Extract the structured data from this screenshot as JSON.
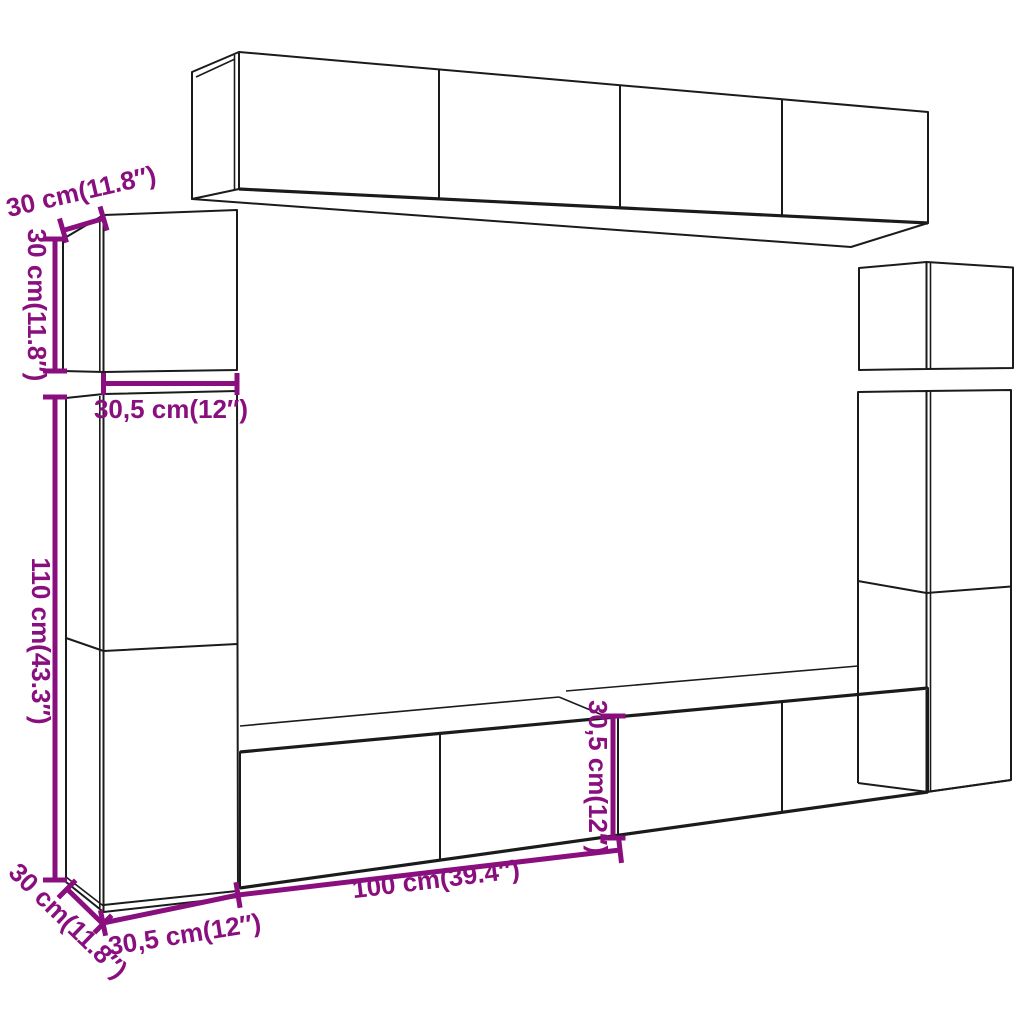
{
  "figure": {
    "title": "TV wall unit set dimension diagram",
    "background_color": "#ffffff",
    "outline_color": "#1b1b1b",
    "dimension_color": "#8A0F7E"
  },
  "parts": [
    {
      "id": "wall-cabinet-top"
    },
    {
      "id": "wall-cabinet-small-left"
    },
    {
      "id": "tall-cabinet-left"
    },
    {
      "id": "wall-cabinet-small-right"
    },
    {
      "id": "tall-cabinet-right"
    },
    {
      "id": "tv-stand-bottom"
    }
  ],
  "dimensions": {
    "small_cabinet_depth": "30 cm(11.8″)",
    "small_cabinet_height": "30 cm(11.8″)",
    "small_cabinet_width": "30,5 cm(12″)",
    "tall_cabinet_height": "110 cm(43.3″)",
    "stand_depth": "30 cm(11.8″)",
    "stand_left_width": "30,5 cm(12″)",
    "stand_length": "100 cm(39.4″)",
    "stand_front_height": "30,5 cm(12″)"
  }
}
